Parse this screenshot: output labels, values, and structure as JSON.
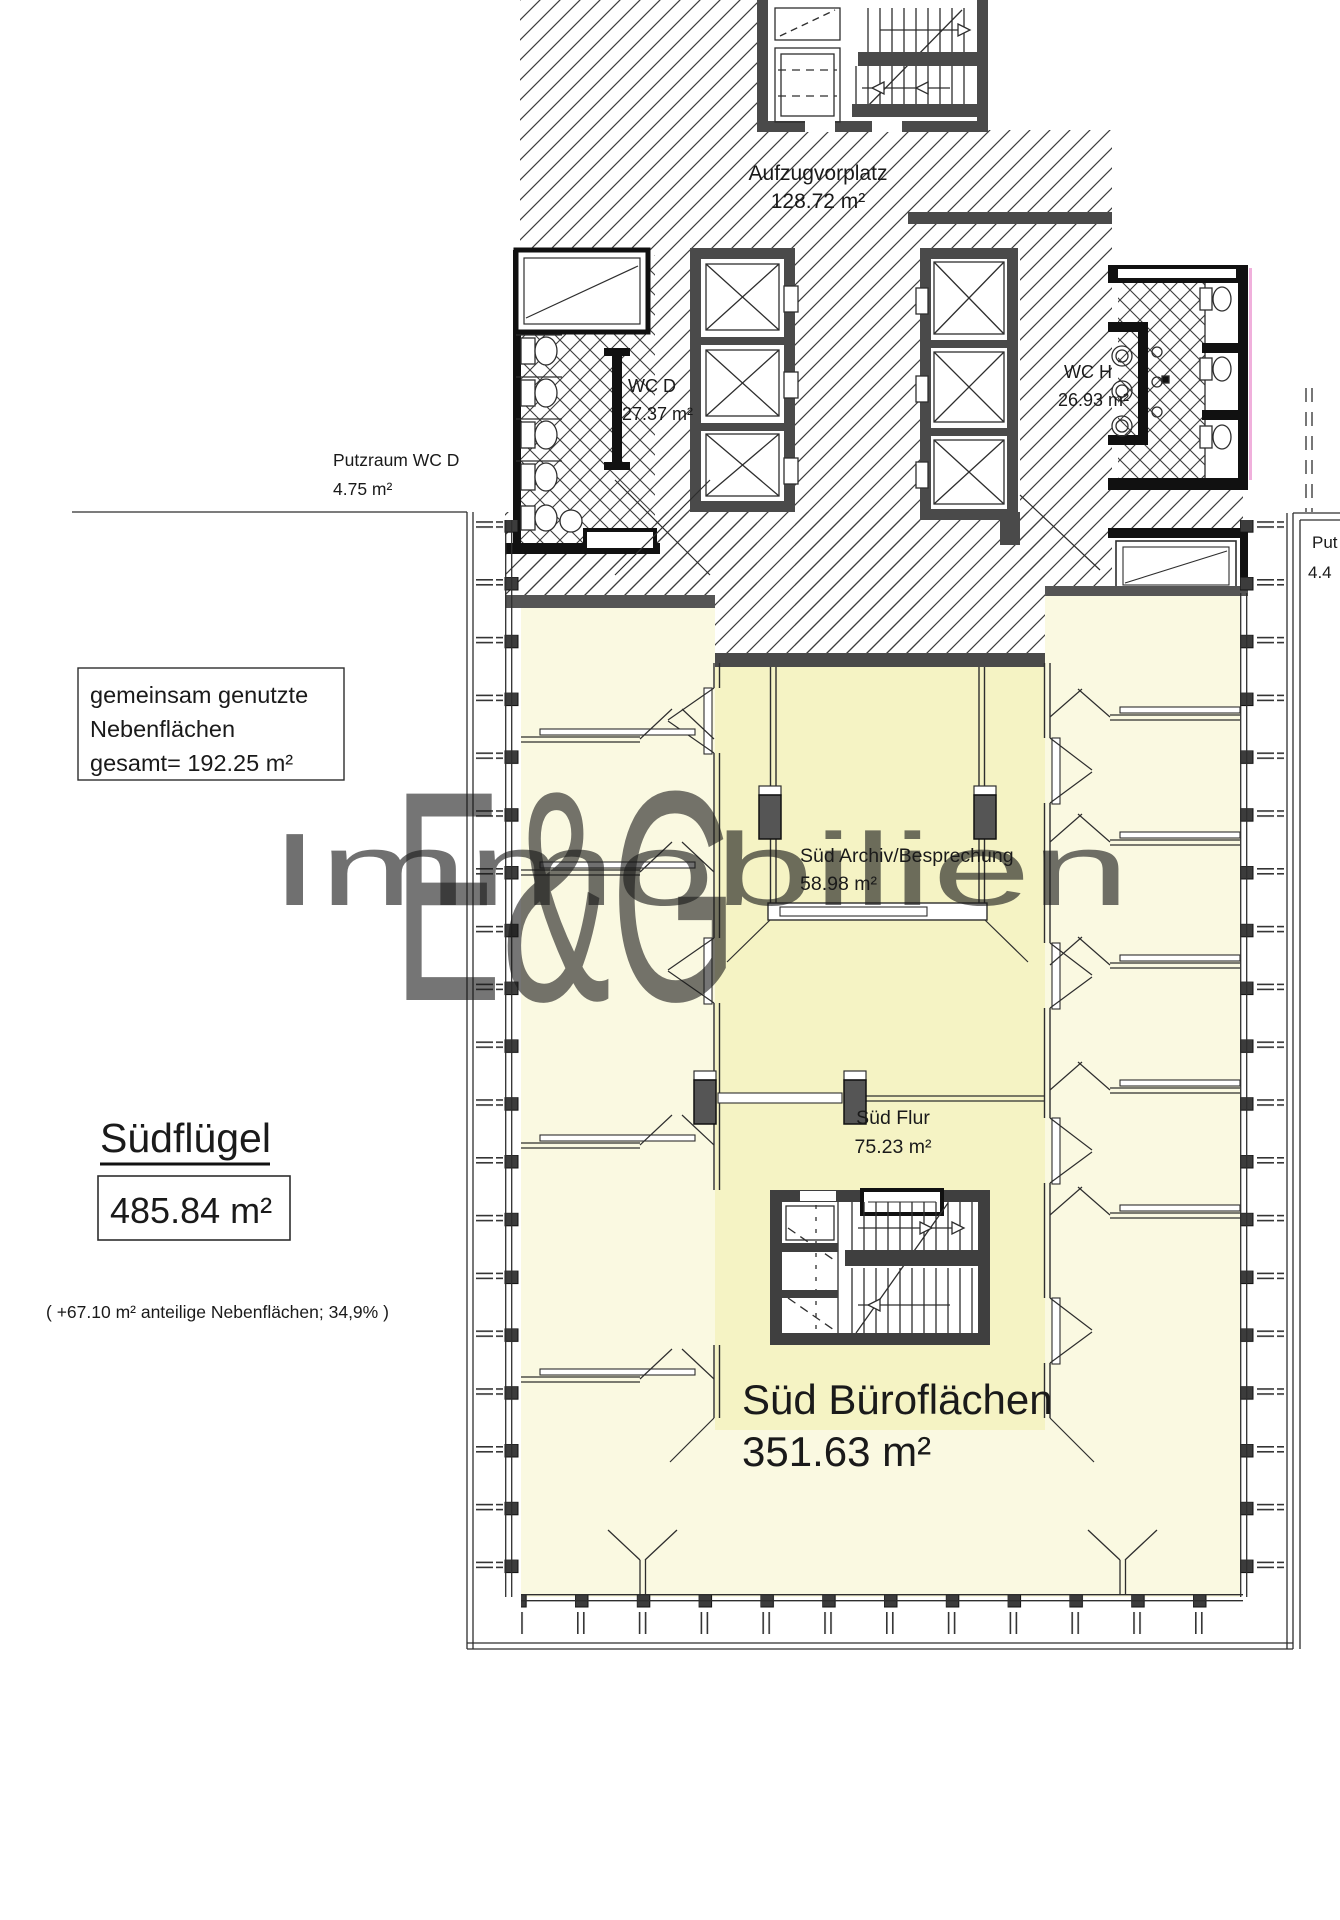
{
  "labels": {
    "aufzugvorplatz": {
      "name": "Aufzugvorplatz",
      "area": "128.72 m²"
    },
    "wc_d": {
      "name": "WC D",
      "area": "27.37 m²"
    },
    "wc_h": {
      "name": "WC H",
      "area": "26.93 m²"
    },
    "putzraum_wc_d": {
      "name": "Putzraum WC D",
      "area": "4.75 m²"
    },
    "putzraum_right": {
      "name": "Put",
      "area": "4.4"
    },
    "archiv": {
      "name": "Süd Archiv/Besprechung",
      "area": "58.98 m²"
    },
    "flur": {
      "name": "Süd Flur",
      "area": "75.23 m²"
    },
    "buero": {
      "name": "Süd Büroflächen",
      "area": "351.63 m²"
    }
  },
  "shared_note": {
    "line1": "gemeinsam genutzte",
    "line2": "Nebenflächen",
    "line3": "gesamt= 192.25 m²"
  },
  "summary": {
    "title": "Südflügel",
    "area": "485.84 m²",
    "note": "( +67.10 m² anteilige Nebenflächen; 34,9% )"
  },
  "watermark": {
    "line1": "E&G",
    "line2": "Immobilien"
  },
  "colors": {
    "office_yellow": "#FAF9E1",
    "corridor_yellow": "#F5F3C4",
    "wall_gray": "#4a4a4a",
    "fixture_black": "#111111",
    "line": "#2e2e2e",
    "accent_pink": "#f0b0dc",
    "watermark_white": "#ffffff"
  }
}
